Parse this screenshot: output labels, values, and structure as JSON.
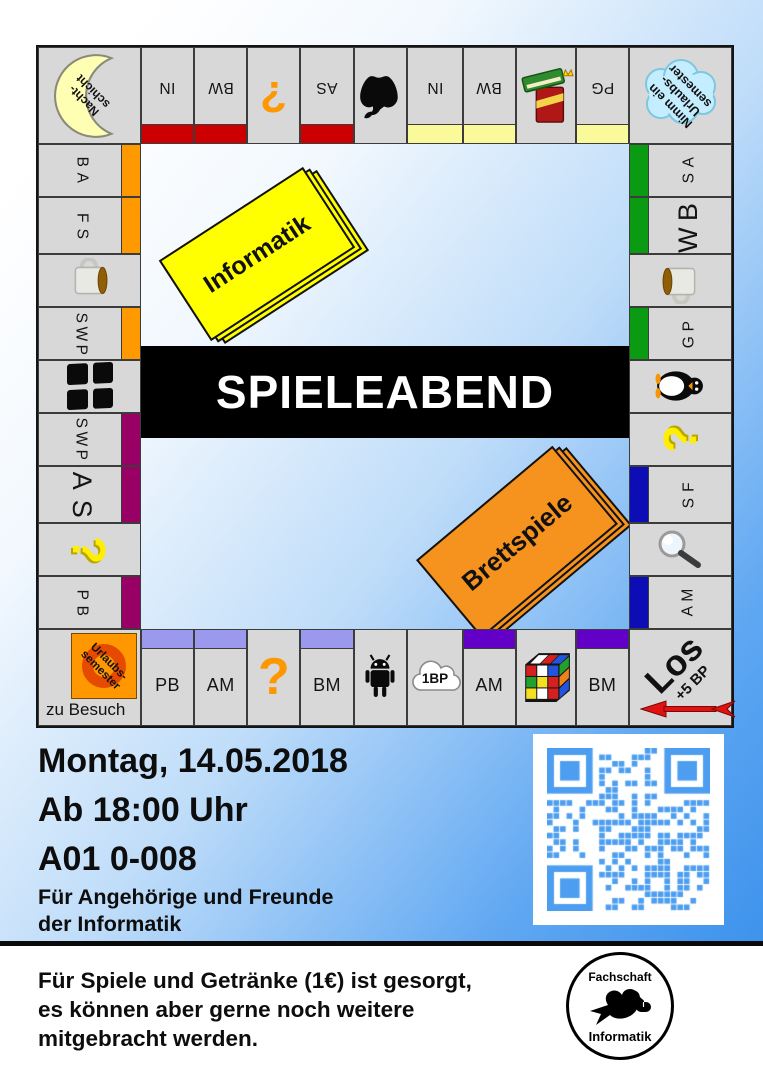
{
  "board": {
    "symbols": {
      "question": "?"
    },
    "corners": {
      "top_left": {
        "lines": [
          "Nacht-",
          "schicht"
        ]
      },
      "top_right": {
        "lines": [
          "Nimm ein",
          "Urlaubs-",
          "semester"
        ]
      },
      "bottom_left": {
        "badge_lines": [
          "Urlaubs-",
          "semester"
        ],
        "caption": "zu Besuch"
      },
      "bottom_right": {
        "label": "Los",
        "bonus": "+5 BP"
      }
    },
    "group_colors": {
      "red": "#cc0000",
      "pale_yellow": "#fafa9b",
      "orange": "#ff9900",
      "magenta": "#990066",
      "green": "#0a9b12",
      "blue": "#0d0db5",
      "lavender": "#9a99ed",
      "violet": "#6200c8"
    },
    "top_row": [
      {
        "label": "IN",
        "bar": "#cc0000"
      },
      {
        "label": "BW",
        "bar": "#cc0000"
      },
      {
        "icon": "question-mark",
        "color": "#ff9800"
      },
      {
        "label": "AS",
        "bar": "#cc0000"
      },
      {
        "icon": "apple"
      },
      {
        "label": "IN",
        "bar": "#fafa9b"
      },
      {
        "label": "BW",
        "bar": "#fafa9b"
      },
      {
        "icon": "books"
      },
      {
        "label": "PG",
        "bar": "#fafa9b"
      }
    ],
    "left_col": [
      {
        "label": "BA",
        "bar": "#ff9900"
      },
      {
        "label": "FS",
        "bar": "#ff9900"
      },
      {
        "icon": "coffee-mug"
      },
      {
        "label": "SWP",
        "bar": "#ff9900"
      },
      {
        "icon": "window"
      },
      {
        "label": "SWP",
        "bar": "#990066"
      },
      {
        "label": "AS",
        "bar": "#990066"
      },
      {
        "icon": "question-mark",
        "color": "#ffee00"
      },
      {
        "label": "PB",
        "bar": "#990066"
      }
    ],
    "right_col": [
      {
        "label": "AS",
        "bar": "#0a9b12"
      },
      {
        "label": "BW",
        "bar": "#0a9b12"
      },
      {
        "icon": "coffee-mug"
      },
      {
        "label": "PG",
        "bar": "#0a9b12"
      },
      {
        "icon": "penguin"
      },
      {
        "icon": "question-mark",
        "color": "#ffee00"
      },
      {
        "label": "FS",
        "bar": "#0d0db5"
      },
      {
        "icon": "magnifier"
      },
      {
        "label": "MA",
        "bar": "#0d0db5"
      }
    ],
    "bottom_row": [
      {
        "label": "PB",
        "bar": "#9a99ed"
      },
      {
        "label": "AM",
        "bar": "#9a99ed"
      },
      {
        "icon": "question-mark",
        "color": "#ff9800"
      },
      {
        "label": "BM",
        "bar": "#9a99ed"
      },
      {
        "icon": "android-robot"
      },
      {
        "icon": "cloud",
        "label": "1BP"
      },
      {
        "label": "AM",
        "bar": "#6200c8"
      },
      {
        "icon": "rubiks-cube"
      },
      {
        "label": "BM",
        "bar": "#6200c8"
      }
    ]
  },
  "center": {
    "banner": "SPIELEABEND",
    "deck_informatik": "Informatik",
    "deck_brettspiele": "Brettspiele"
  },
  "event": {
    "date": "Montag, 14.05.2018",
    "time": "Ab 18:00 Uhr",
    "room": "A01 0-008",
    "audience_line1": "Für Angehörige und Freunde",
    "audience_line2": "der Informatik"
  },
  "footer": {
    "line1": "Für Spiele und Getränke (1€) ist gesorgt,",
    "line2": "es können aber gerne noch weitere",
    "line3": "mitgebracht werden.",
    "logo_top": "Fachschaft",
    "logo_bottom": "Informatik"
  },
  "qr": {
    "color": "#4d9ef0"
  }
}
